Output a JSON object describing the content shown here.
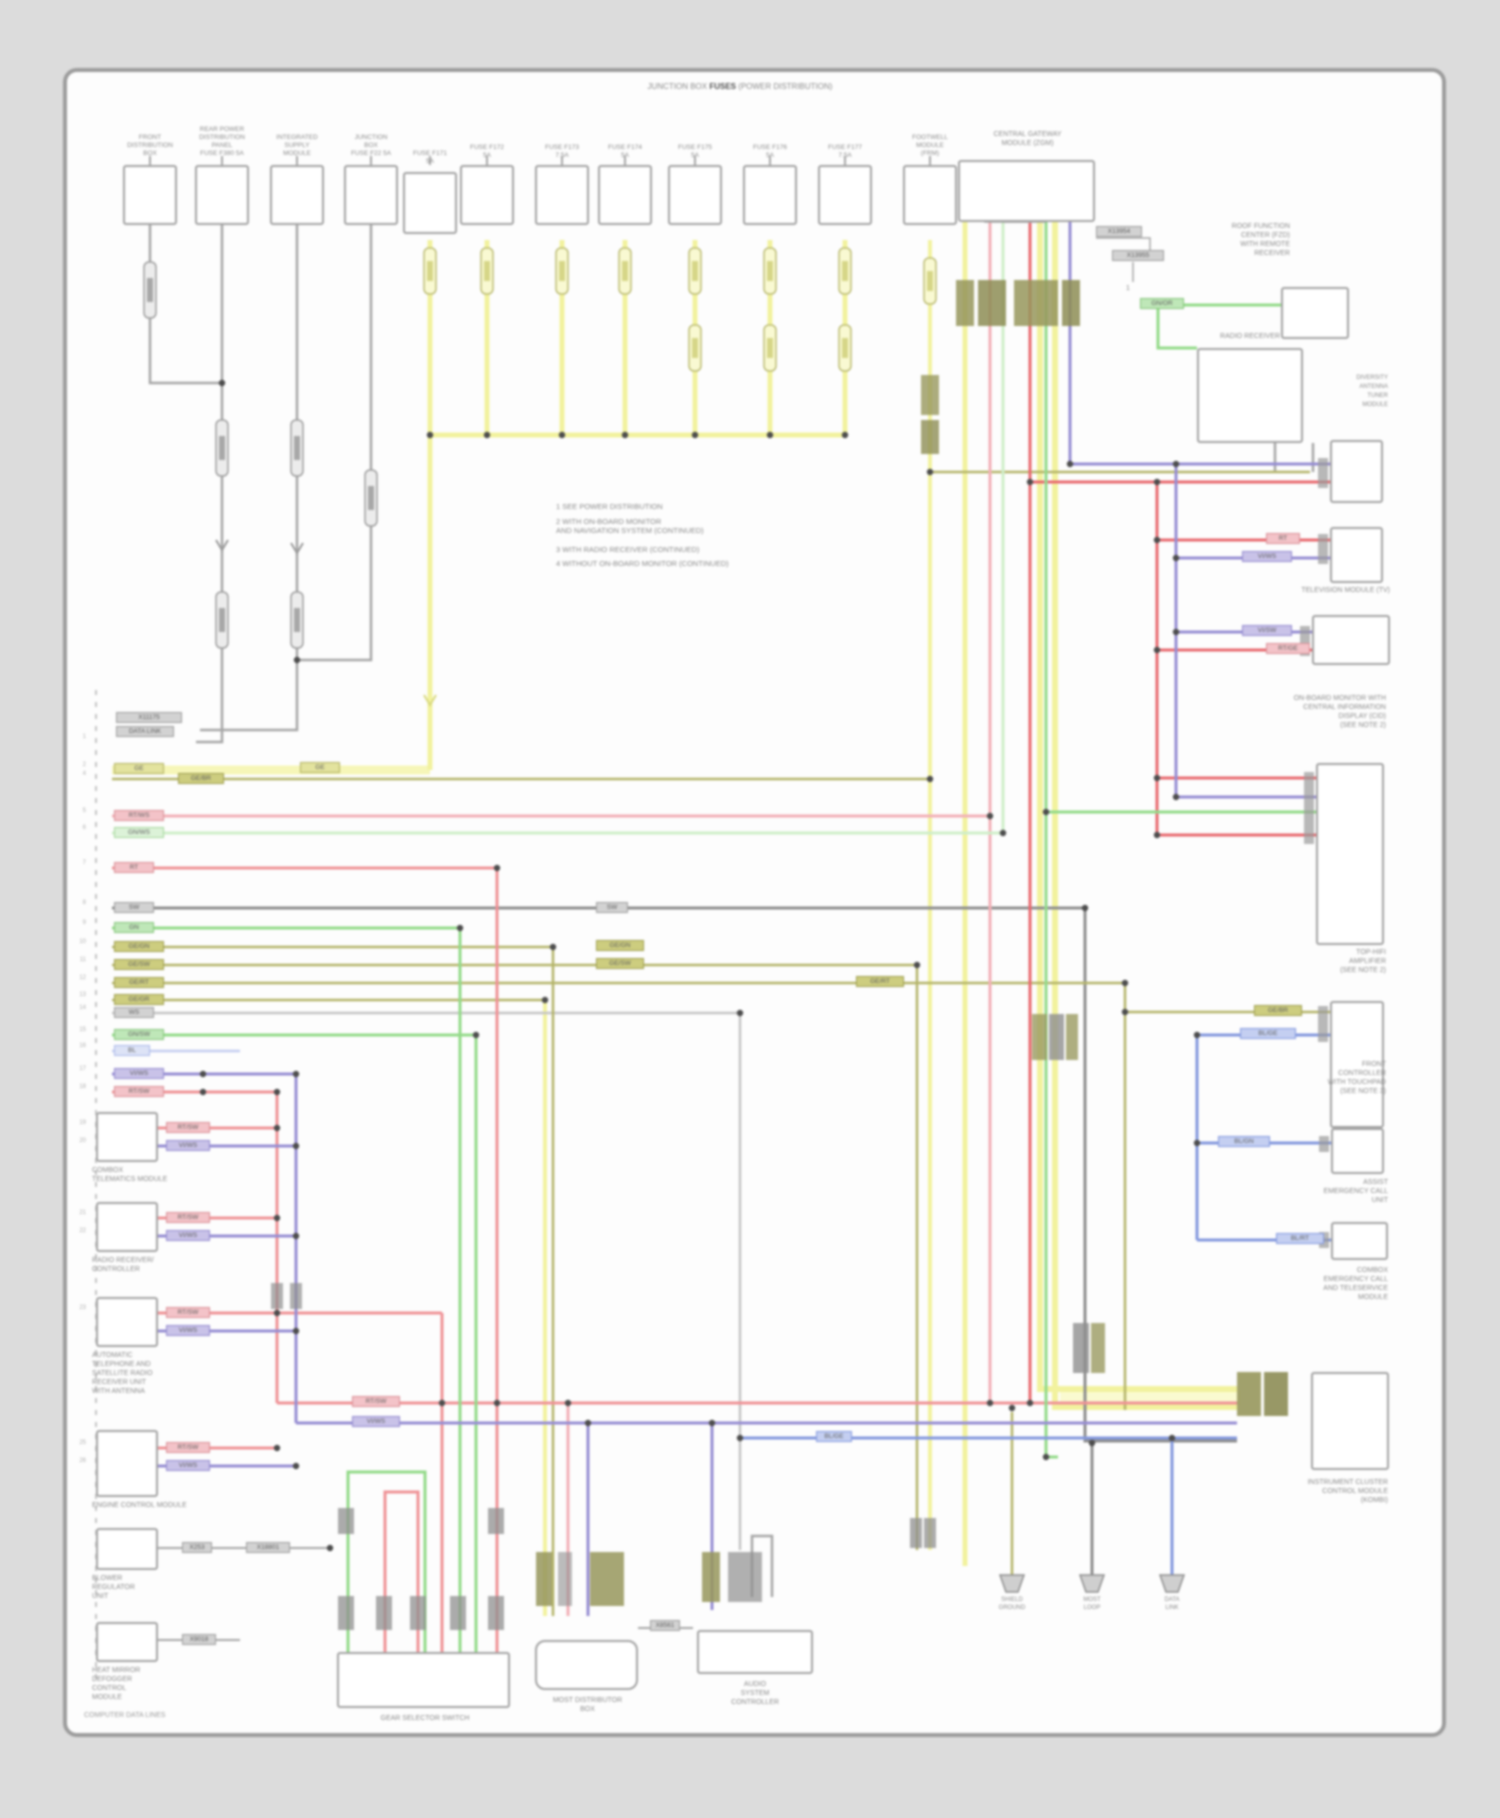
{
  "diagram": {
    "footer_left": "COMPUTER DATA LINES",
    "bracket": {
      "pre": "JUNCTION BOX ",
      "bold": "FUSES",
      "post": " (POWER DISTRIBUTION)"
    },
    "gateway_label": "CENTRAL GATEWAY\nMODULE (ZGM)",
    "notes": [
      "1   SEE POWER DISTRIBUTION",
      "2   WITH ON-BOARD MONITOR\n      AND NAVIGATION SYSTEM (CONTINUED)",
      "3   WITH RADIO RECEIVER (CONTINUED)",
      "4   WITHOUT ON-BOARD MONITOR (CONTINUED)"
    ],
    "top_components": [
      {
        "label": "FRONT\nDISTRIBUTION\nBOX"
      },
      {
        "label": "REAR POWER\nDISTRIBUTION\nPANEL\nFUSE F380 5A"
      },
      {
        "label": "INTEGRATED\nSUPPLY\nMODULE"
      },
      {
        "label": "JUNCTION\nBOX\nFUSE F22 5A"
      },
      {
        "label": "FUSE F171\n5A"
      },
      {
        "label": "FUSE F172\n5A"
      },
      {
        "label": "FUSE F173\n7.5A"
      },
      {
        "label": "FUSE F174\n5A"
      },
      {
        "label": "FUSE F175\n5A"
      },
      {
        "label": "FUSE F176\n5A"
      },
      {
        "label": "FUSE F177\n7.5A"
      },
      {
        "label": "FOOTWELL\nMODULE\n(FRM)"
      }
    ],
    "left_modules": [
      {
        "label": "COMBOX\nTELEMATICS MODULE"
      },
      {
        "label": "RADIO RECEIVER/\nCONTROLLER"
      },
      {
        "label": "AUTOMATIC\nTELEPHONE AND\nSATELLITE RADIO\nRECEIVER UNIT\nWITH ANTENNA"
      },
      {
        "label": "ENGINE CONTROL MODULE"
      },
      {
        "label": "BLOWER\nREGULATOR\nUNIT"
      },
      {
        "label": "HEAT MIRROR\nDEFOGGER\nCONTROL\nMODULE"
      }
    ],
    "bottom_modules": [
      {
        "label": "GEAR SELECTOR SWITCH"
      },
      {
        "label": "MOST DISTRIBUTOR\nBOX"
      },
      {
        "label": "AUDIO\nSYSTEM\nCONTROLLER"
      }
    ],
    "splices": [
      {
        "label": "SHIELD\nGROUND"
      },
      {
        "label": "MOST\nLOOP"
      },
      {
        "label": "DATA\nLINK"
      }
    ],
    "right_modules": {
      "ra": "ROOF FUNCTION\nCENTER (FZD)\nWITH REMOTE\nRECEIVER",
      "rb_title": "RADIO RECEIVER",
      "rb_side": "DIVERSITY\nANTENNA\nTUNER\nMODULE",
      "re_under": "TELEVISION MODULE (TV)",
      "rf": "TOP-HIFI\nAMPLIFIER\n(SEE NOTE 2)",
      "rg_above": "ON-BOARD MONITOR WITH\nCENTRAL INFORMATION\nDISPLAY (CID)\n(SEE NOTE 2)",
      "rh_side": "FRONT\nCONTROLLER\nWITH TOUCHPAD\n(SEE NOTE 3)",
      "ri_above": "ASSIST\nEMERGENCY CALL\nUNIT",
      "ri_below": "COMBOX\nEMERGENCY CALL\nAND TELESERVICE\nMODULE",
      "rj_below": "INSTRUMENT CLUSTER\nCONTROL MODULE\n(KOMBI)",
      "antenna_pin": "1"
    },
    "wire_tags": [
      "GE",
      "GE/BR",
      "RT/WS",
      "GN/WS",
      "RT",
      "SW",
      "GN",
      "GE/GN",
      "GE/SW",
      "GE/RT",
      "GE/GR",
      "WS",
      "GN/SW",
      "BL",
      "VI/WS",
      "RT/SW",
      "X11175",
      "DATA LINK",
      "RT/SW",
      "VI/WS",
      "RT/SW",
      "VI/WS",
      "RT/SW",
      "VI/WS",
      "RT/SW",
      "VI/WS",
      "X253",
      "X18801",
      "X9018",
      "X8561",
      "RT/SW",
      "VI/WS",
      "BL/GE",
      "SW",
      "GE/GN",
      "GE/SW",
      "GE/RT",
      "RT",
      "VI/WS",
      "VI/SW",
      "RT/GE",
      "GE/BR",
      "BL/GN",
      "BL/RT",
      "BL/GE",
      "X13954",
      "X13955",
      "GN/OR",
      "GE"
    ],
    "pin_numbers": [
      "1",
      "2",
      "4",
      "5",
      "6",
      "7",
      "8",
      "9",
      "10",
      "11",
      "12",
      "13",
      "14",
      "15",
      "16",
      "17",
      "18",
      "19",
      "20",
      "21",
      "22",
      "23",
      "25",
      "26"
    ],
    "colors": {
      "wire_gray": "#a6a6a6",
      "wire_yellow": "#f2f29e",
      "wire_olive": "#b4b468",
      "wire_red": "#ef9296",
      "wire_red_strong": "#e8696f",
      "wire_pink": "#f2b0b6",
      "wire_green": "#93da89",
      "wire_pale_green": "#cfeec9",
      "wire_violet": "#968dd2",
      "wire_blue": "#8398de",
      "page_border": "#9c9c9c"
    }
  }
}
